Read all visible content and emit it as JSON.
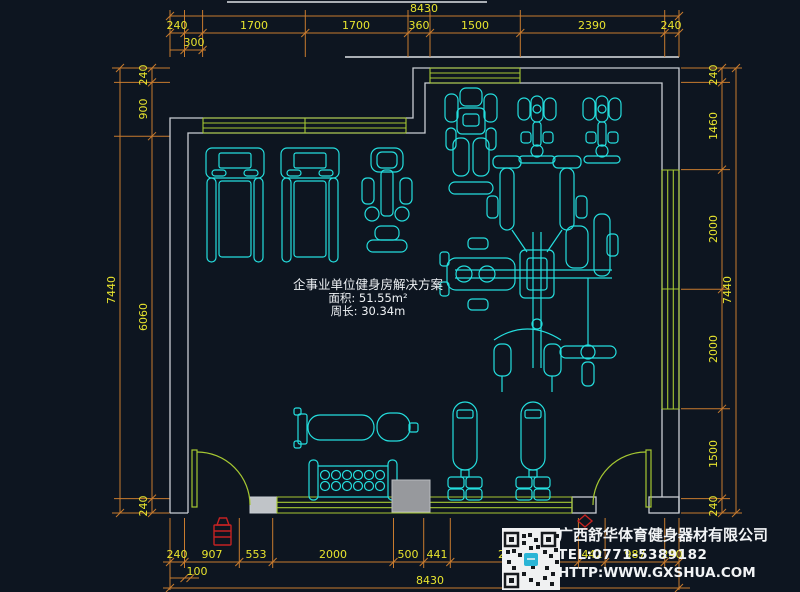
{
  "colors": {
    "background": "#0d1520",
    "wall": "#c9ced4",
    "window_green": "#a6c832",
    "equipment_cyan": "#24dede",
    "dimension_line_orange": "#c87b2e",
    "dimension_text_yellow": "#e8e42e",
    "label_white": "#eef1f4",
    "hydrant_red": "#c42222",
    "qr_logo_cyan": "#2ab5d6"
  },
  "drawing": {
    "title": "企事业单位健身房解决方案",
    "area_label": "面积: 51.55m²",
    "perimeter_label": "周长: 30.34m"
  },
  "dimensions": {
    "top": {
      "total": "8430",
      "chain": [
        "240",
        "1700",
        "1700",
        "360",
        "1500",
        "2390",
        "240"
      ],
      "sub": "300"
    },
    "bottom": {
      "total": "8430",
      "chain": [
        "240",
        "907",
        "553",
        "2000",
        "500",
        "441",
        "2120",
        "442",
        "987",
        "240"
      ],
      "sub": "100"
    },
    "left": {
      "total": "7440",
      "chain": [
        "240",
        "900",
        "6060",
        "240"
      ]
    },
    "right": {
      "total": "7440",
      "chain": [
        "240",
        "1460",
        "2000",
        "2000",
        "1500",
        "240"
      ]
    }
  },
  "company": {
    "name": "广西舒华体育健身器材有限公司",
    "tel": "TEL:0771-5389182",
    "website": "HTTP:WWW.GXSHUA.COM"
  }
}
